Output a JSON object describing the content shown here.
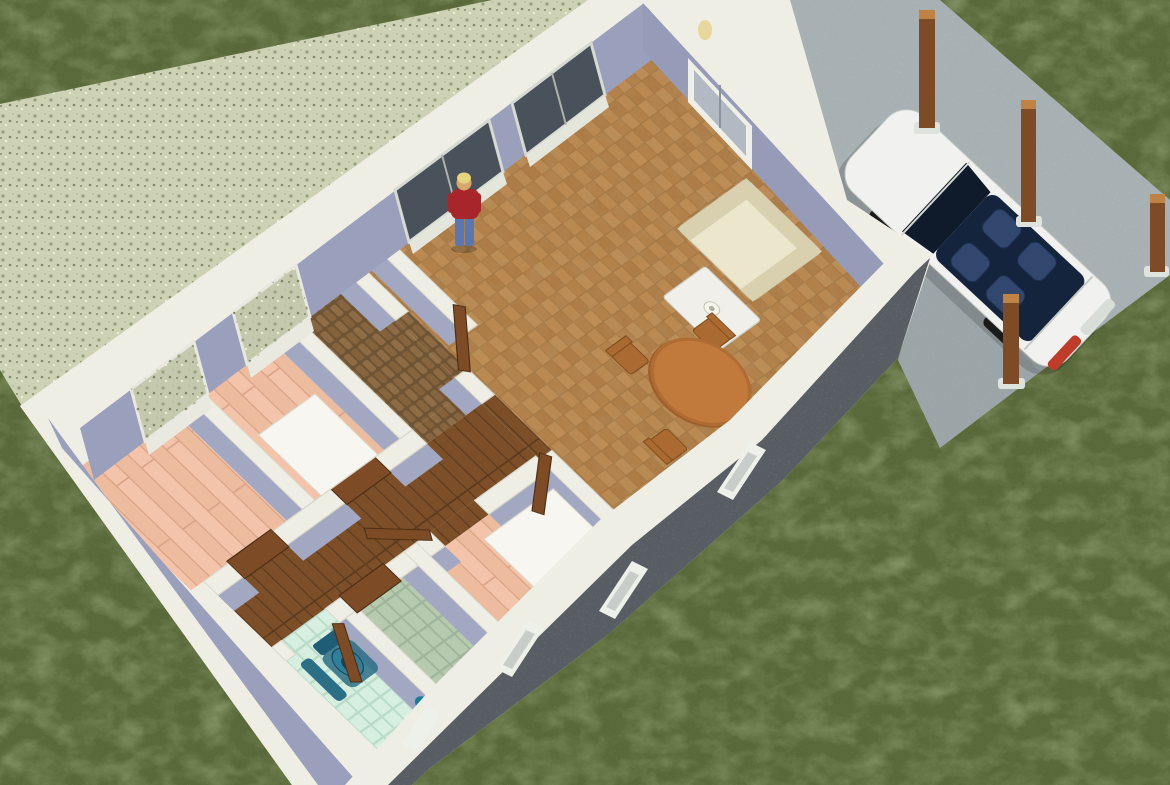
{
  "scene": {
    "type": "3d-home-design-render",
    "view": "aerial cutaway (roofless) perspective",
    "labels": {
      "scene": "3D cutaway rendering of a single-storey house with yard, driveway and car",
      "lawn": "Green lawn",
      "terrace": "Speckled gravel terrace along the rear wall",
      "driveway": "Concrete driveway and carport slab",
      "posts": "Wooden carport posts",
      "house": "Single-storey house shown without roof",
      "living_room": "Living / dining room with terracotta stone floor",
      "hall": "Entry hall with cobblestone floor",
      "corridor": "Corridor with dark wood floor",
      "bedroom_a": "Bedroom with pink plank floor and white bed",
      "bedroom_b": "Second bedroom with pink plank floor",
      "bedroom_c": "Center bedroom with pink plank floor and white bed",
      "green_room": "Room with green-grey tile floor",
      "bathroom": "Bathroom with mint tile floor and blue toilet",
      "sofa": "Cream three-seat sofa",
      "coffee_table": "Light coffee table with small white lamp",
      "dining_set": "Round wooden dining table with four chairs",
      "sideboard": "Brick-red sideboard against the front wall",
      "bed": "White double bed",
      "toilet": "Blue toilet with bath mats",
      "person": "Person with blonde hair, red shirt and blue jeans",
      "car": "White convertible car with dark blue interior",
      "back_glazing": "Sliding glass doors and windows in the rear wall",
      "front_windows": "Small white windows in the dark front wall"
    },
    "counts": {
      "carport_posts": 4,
      "front_wall_windows": 4,
      "rear_glass_doors": 2,
      "rear_windows": 2,
      "open_doors": 4,
      "closed_doors": 3,
      "beds": 2
    }
  },
  "palette": {
    "grass": "#5a693a",
    "gravel": "#ced2b4",
    "driveway": "#a7b0b2",
    "cap": "#efeee4",
    "lavender": "#9aa0bc",
    "lavender2": "#a2a8c2",
    "frontFace": "#575d62",
    "terracotta": "#b5834e",
    "pinkFloor": "#f2c2a6",
    "mint": "#d6eee0",
    "greenTile": "#b6caaf",
    "cobble": "#6e5434",
    "wood": "#7c4f29",
    "door": "#7d4c27",
    "glass": "#49525a",
    "sofa": "#e9e3c9",
    "sofaTrim": "#d8d0ae",
    "coffee": "#f0efe9",
    "tableWood": "#c2793c",
    "chairWood": "#aa6a32",
    "sideboard": "#b0522f",
    "bed": "#f7f6f1",
    "toilet": "#2f7e9b",
    "matBlue": "#2b6f86",
    "teal": "#177f9b",
    "carBody": "#f1f2ef",
    "carCabin": "#15243d",
    "carSeat": "#31476d",
    "windshield": "#0f1b2a",
    "tail": "#bf3c28",
    "post": "#7d4b26",
    "postTop": "#bf8445",
    "shirt": "#a8262b",
    "jeans": "#5a77b5",
    "hair": "#e7d37d",
    "skin": "#d8a76e"
  }
}
